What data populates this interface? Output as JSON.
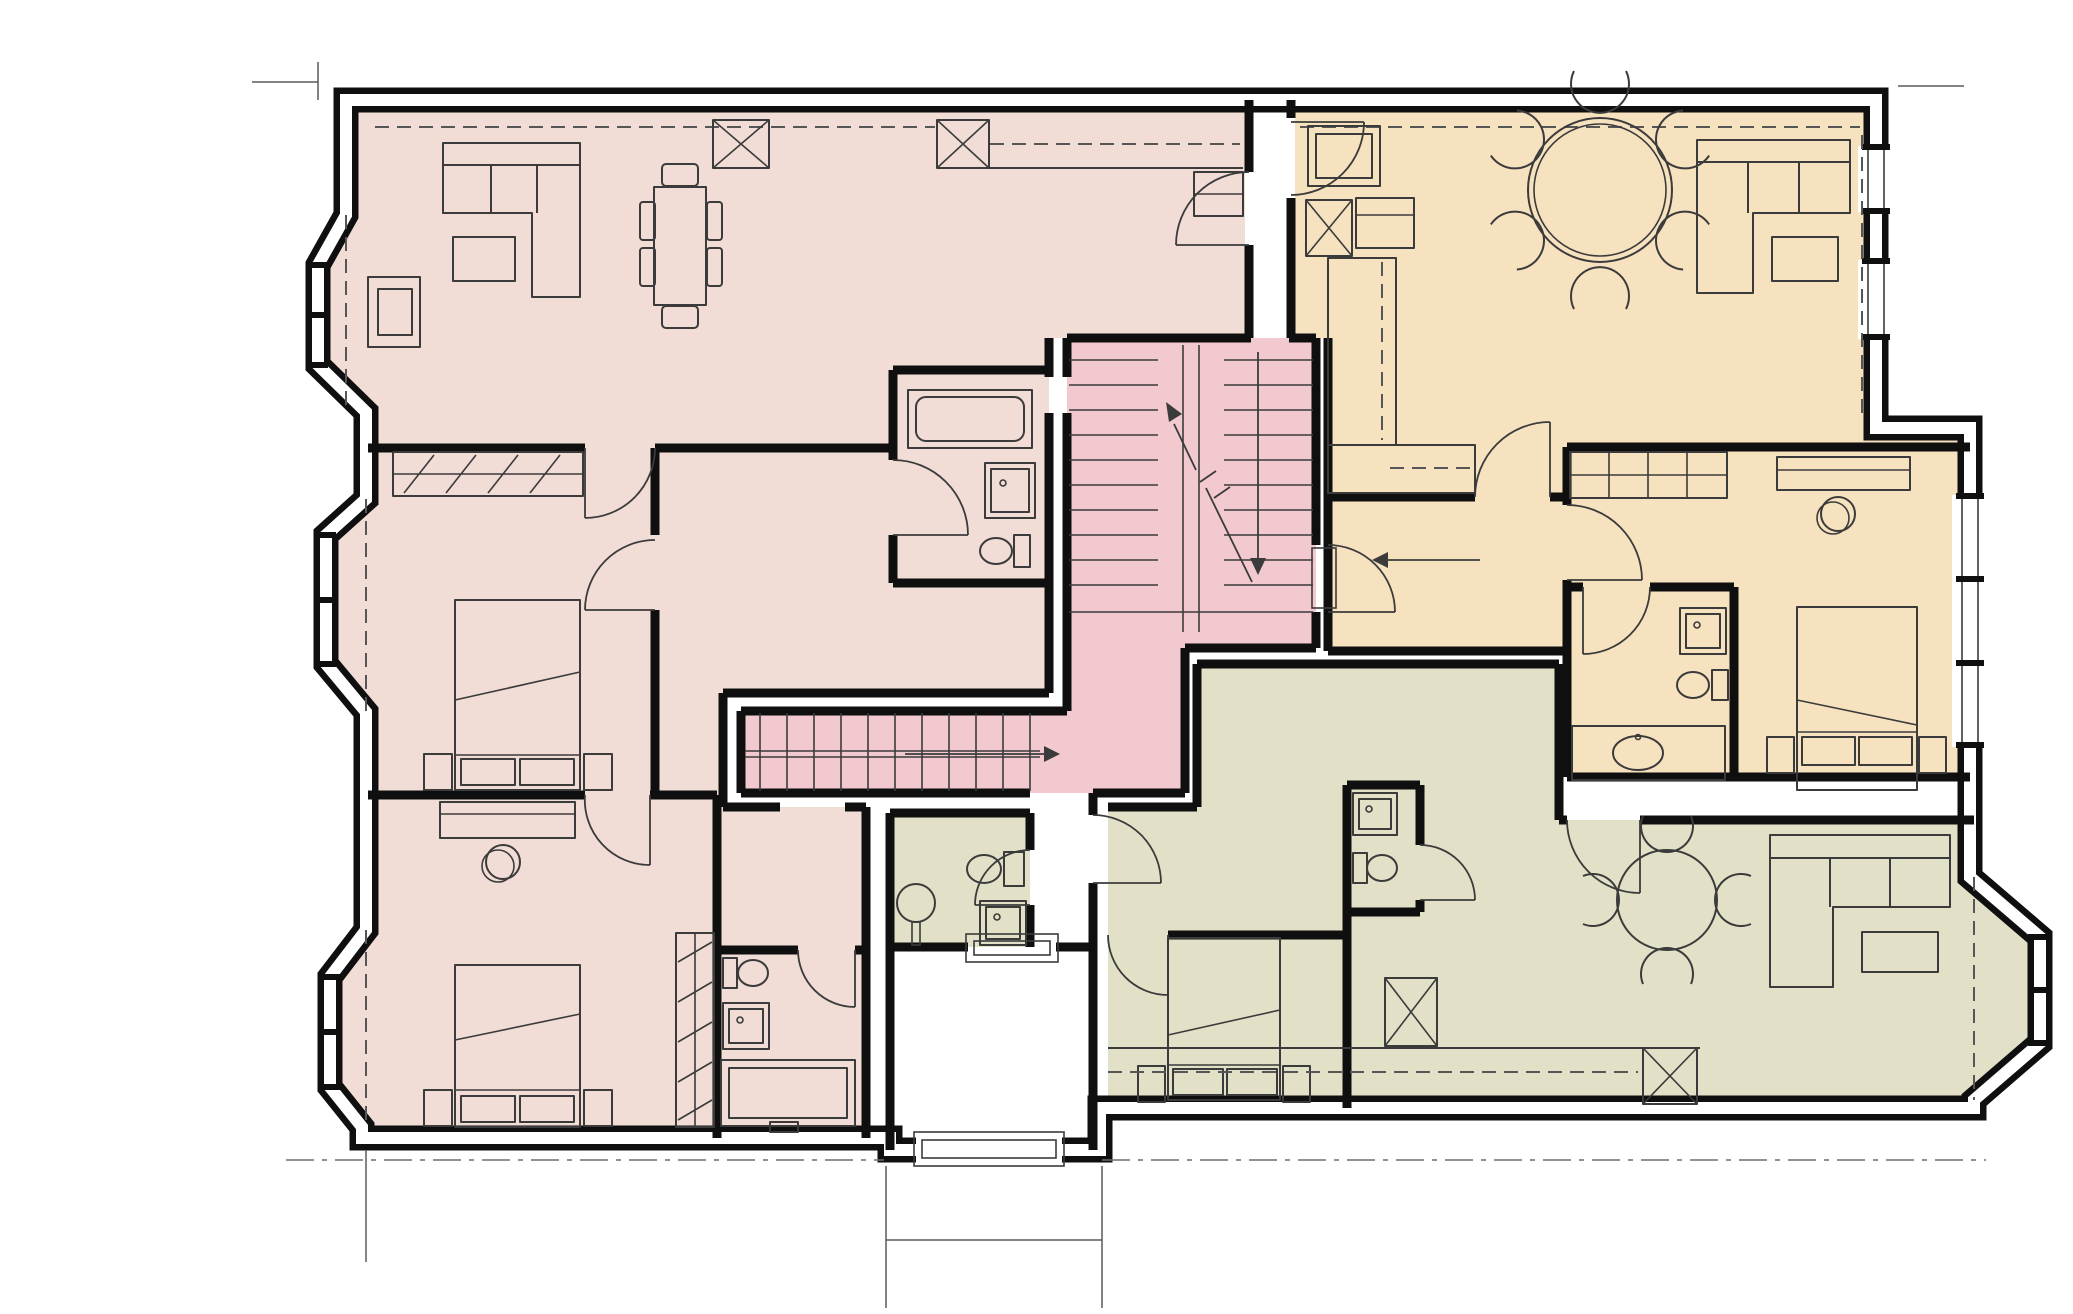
{
  "document": {
    "kind": "architectural floor plan",
    "description": "Upper floor plan of a converted house containing three flats around a common stair core, drawn in hand-sketch style with no text labels",
    "orientation": "entrance lobby and footpath at bottom centre"
  },
  "colors": {
    "background": "#ffffff",
    "wall": "#0f0f0f",
    "furniture_line": "#3b3b3b",
    "flat_pink": "#f1dcd6",
    "flat_orange": "#f7e2bf",
    "flat_green": "#e2e1c7",
    "stair_core": "#f2c9ce"
  },
  "flats": [
    {
      "id": "flat-1",
      "color_key": "flat_pink",
      "position": "left half of building",
      "rooms": [
        "open plan living / dining / kitchen",
        "bedroom 1",
        "bedroom 2",
        "bathroom",
        "wc / shower room",
        "hall"
      ],
      "furniture": [
        "L-shaped sofa",
        "coffee table",
        "armchair",
        "dining table with six chairs",
        "kitchen counter with crossed appliance boxes",
        "fitted wardrobes",
        "two double beds",
        "dressing table with stool",
        "bath",
        "shower trays",
        "toilets",
        "storage unit"
      ]
    },
    {
      "id": "flat-2",
      "color_key": "flat_orange",
      "position": "top right of building",
      "rooms": [
        "open plan living / dining / kitchen",
        "bedroom",
        "en-suite bathroom",
        "entrance hall with closets"
      ],
      "furniture": [
        "round dining table with six chairs",
        "L-shaped sofa",
        "coffee table",
        "kitchen counter with crossed appliance box",
        "fitted wardrobe",
        "double bed",
        "dressing table with stool",
        "shower tray",
        "toilet",
        "vanity basin"
      ]
    },
    {
      "id": "flat-3",
      "color_key": "flat_green",
      "position": "bottom right of building",
      "rooms": [
        "living / dining room with bay window",
        "kitchen",
        "bedroom",
        "shower room",
        "bathroom",
        "hall"
      ],
      "furniture": [
        "round dining table with four chairs",
        "L-shaped sofa",
        "coffee table",
        "kitchen counter with two crossed appliance boxes",
        "double bed",
        "shower trays",
        "toilets",
        "pedestal basin"
      ]
    }
  ],
  "common_areas": {
    "stair_core": {
      "color_key": "stair_core",
      "elements": [
        "dog-leg stair with two flights",
        "long straight flight to flat level",
        "direction arrows",
        "half landing"
      ]
    },
    "entrance_lobby": {
      "color_key": "background",
      "elements": [
        "entrance door threshold",
        "footpath lines to street",
        "internal door thresholds"
      ]
    }
  },
  "exterior": {
    "features": [
      "double-leaf external walls",
      "three bay windows on left elevation",
      "bay window on bottom right",
      "window strips on right elevation",
      "site boundary dash-dot lines"
    ]
  }
}
